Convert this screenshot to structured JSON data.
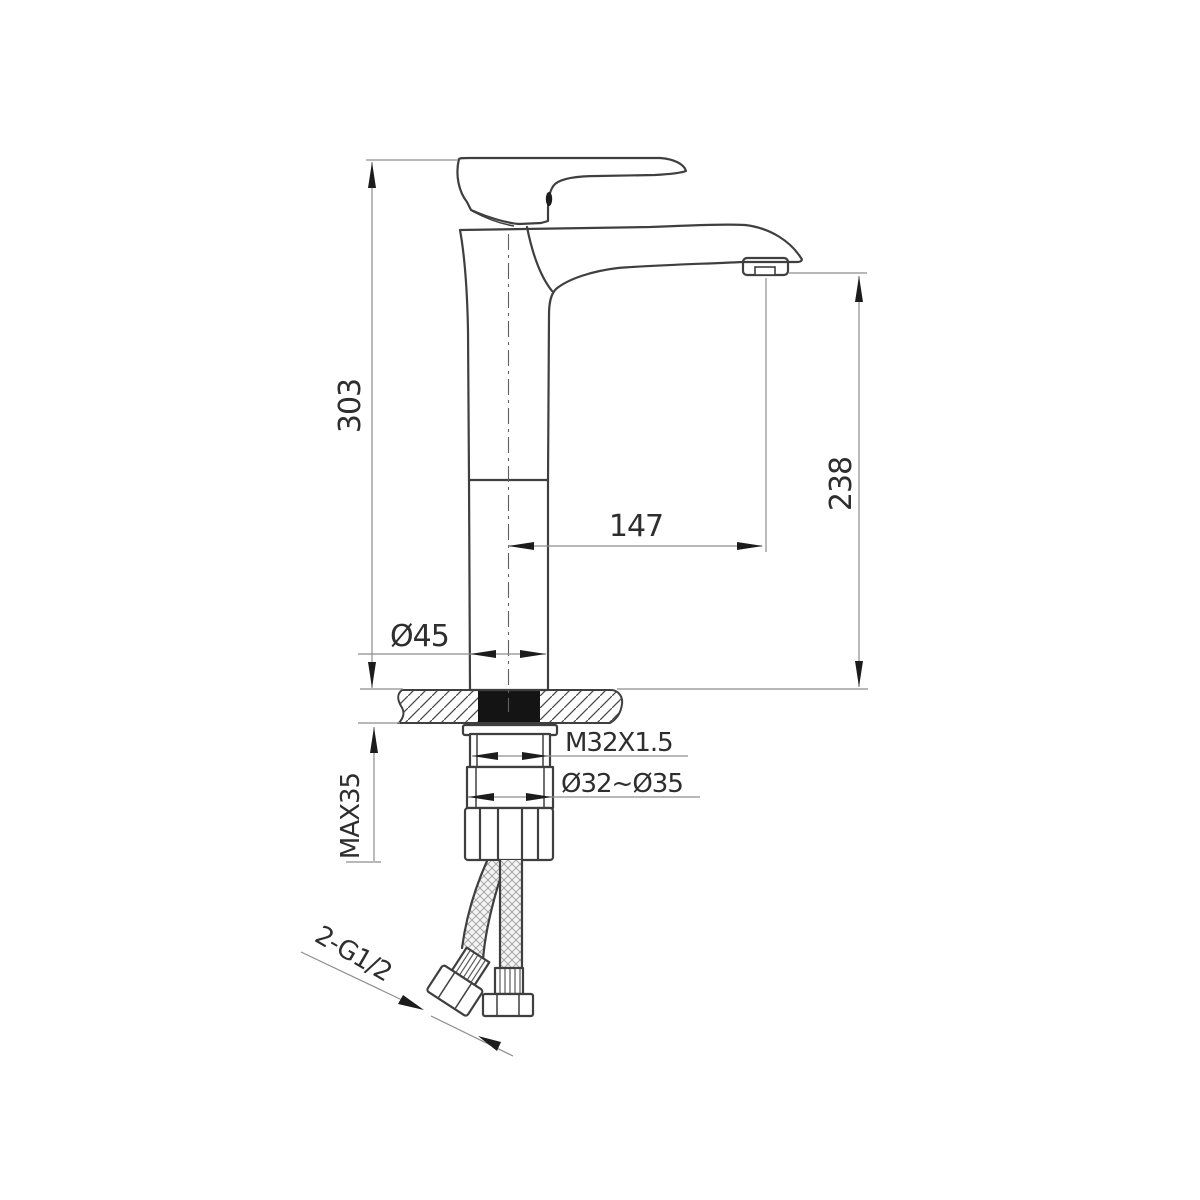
{
  "meta": {
    "kind": "technical dimension drawing",
    "subject": "tall single-lever basin mixer faucet, side elevation with installation dimensions",
    "background_color": "#ffffff",
    "outline_color": "#3f3f3f",
    "dimension_line_color": "#8d8d8d",
    "gasket_color": "#141414"
  },
  "labels": {
    "overall_height": "303",
    "spout_height": "238",
    "spout_reach": "147",
    "body_diameter": "Ø45",
    "shank_thread": "M32X1.5",
    "hole_diameter": "Ø32~Ø35",
    "max_counter_thickness": "MAX35",
    "supply_hose_thread": "2-G1/2"
  }
}
